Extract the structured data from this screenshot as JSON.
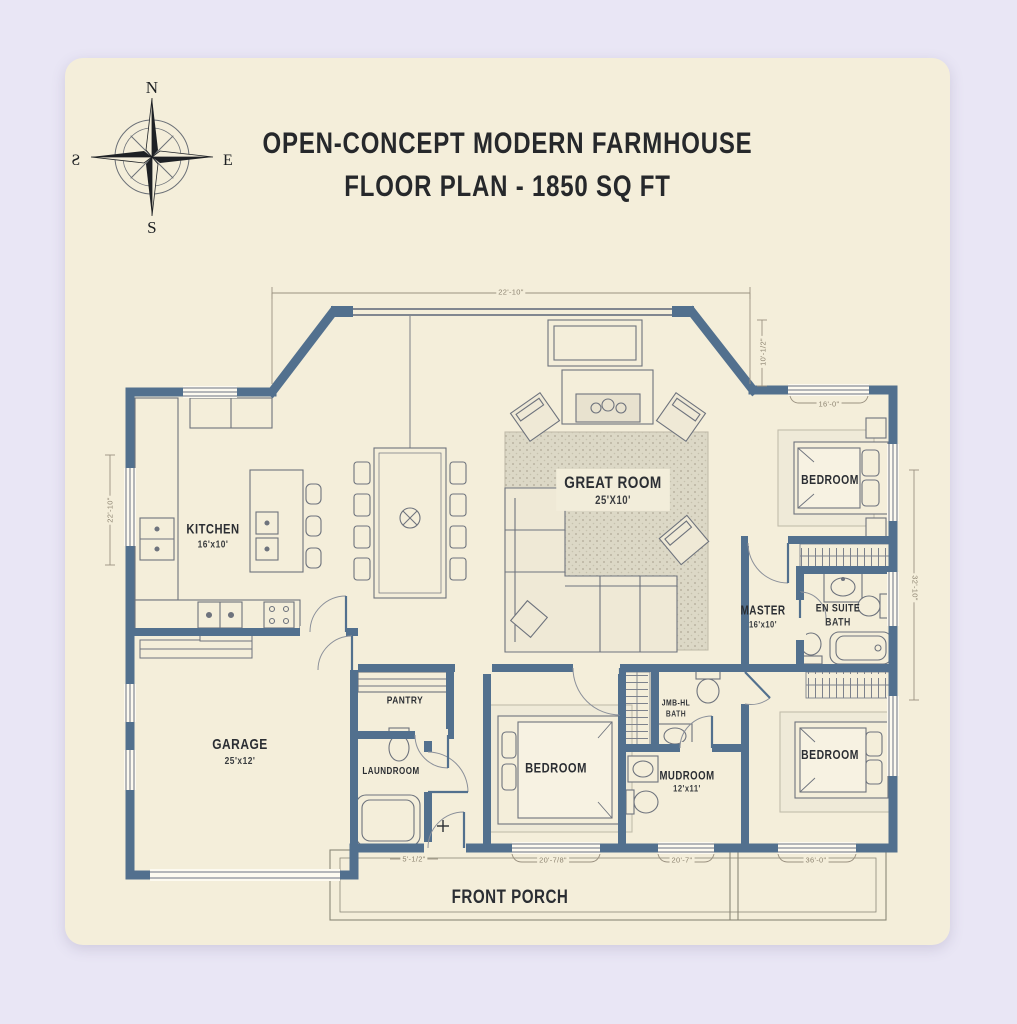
{
  "title": {
    "line1": "OPEN-CONCEPT MODERN FARMHOUSE",
    "line2": "FLOOR PLAN - 1850 SQ FT"
  },
  "compass": {
    "north": "N",
    "east": "E",
    "south": "S",
    "west": "Ƨ"
  },
  "rooms": {
    "kitchen": {
      "label": "KITCHEN",
      "size": "16'x10'"
    },
    "great_room": {
      "label": "GREAT ROOM",
      "size": "25'X10'"
    },
    "bedroom_top_right": {
      "label": "BEDROOM"
    },
    "master": {
      "label": "MASTER",
      "size": "16'x10'"
    },
    "ensuite": {
      "label_line1": "EN SUITE",
      "label_line2": "BATH"
    },
    "garage": {
      "label": "GARAGE",
      "size": "25'x12'"
    },
    "pantry": {
      "label": "PANTRY"
    },
    "laundry": {
      "label": "LAUNDROOM"
    },
    "bedroom_middle": {
      "label": "BEDROOM"
    },
    "hall_bath": {
      "label_line1": "JMB-HL",
      "label_line2": "BATH"
    },
    "mudroom": {
      "label": "MUDROOM",
      "size": "12'x11'"
    },
    "bedroom_bottom_right": {
      "label": "BEDROOM"
    },
    "front_porch": {
      "label": "FRONT PORCH"
    }
  },
  "dimensions": {
    "top_width": "22'-10\"",
    "upper_right_height": "10'-1/2\"",
    "bedroom_window_width": "16'-0\"",
    "left_height": "22'-10\"",
    "right_height": "32'-10\"",
    "front_door_width": "5'-1/2\"",
    "bottom_window_1": "20'-7/8\"",
    "bottom_window_2": "20'-7\"",
    "bottom_window_3": "36'-0\""
  },
  "colors": {
    "page_background": "#e9e6f5",
    "card_background": "#f4eeda",
    "wall": "#52708e",
    "ink": "#2b2e33",
    "dimension_text": "#8d8471"
  }
}
